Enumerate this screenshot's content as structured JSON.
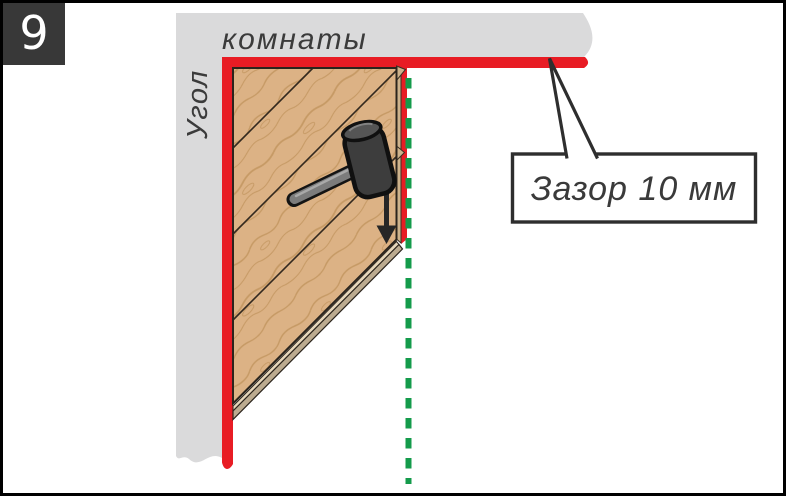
{
  "step_number": "9",
  "labels": {
    "wall_vertical": "Угол",
    "wall_horizontal": "комнаты",
    "callout": "Зазор 10 мм"
  },
  "colors": {
    "gap_red": "#e81c24",
    "wall_gray": "#dadadb",
    "wood_base": "#dcb285",
    "wood_grain": "#c2955f",
    "wood_edge_tan": "#cdb28b",
    "guide_green": "#149b4b"
  },
  "icons": {
    "mallet": "rubber-mallet-icon",
    "arrow": "down-arrow-icon",
    "guide_line": "dashed-guide-line-icon"
  }
}
